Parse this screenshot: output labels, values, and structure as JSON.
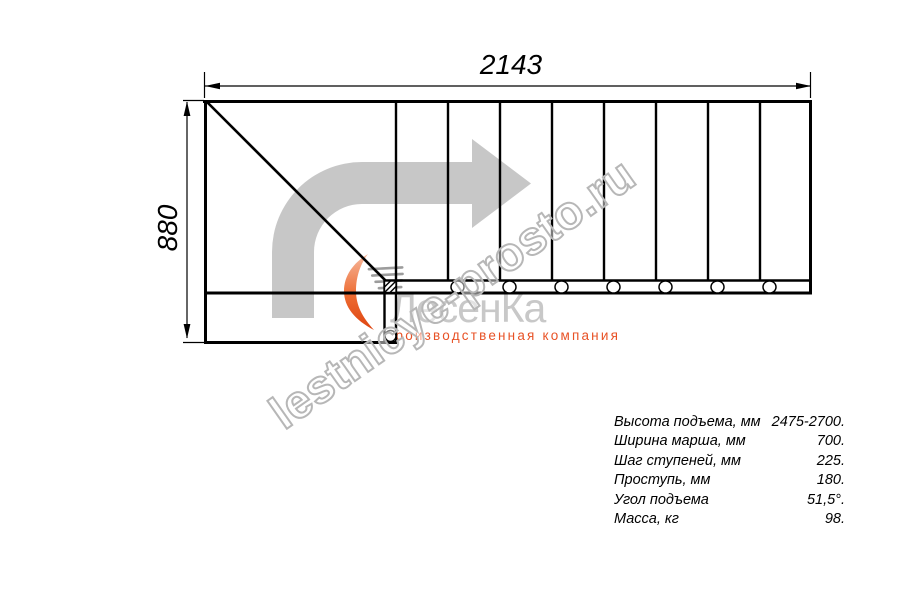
{
  "drawing": {
    "type": "staircase top-view plan",
    "width_label": "2143",
    "height_label": "880",
    "tread_count": 8,
    "colors": {
      "line": "#000000",
      "direction_arrow": "#c7c7c7",
      "watermark_outline": "#b7b7b7",
      "logo_gray": "#c8c8c8",
      "logo_orange": "#e85226"
    }
  },
  "watermark": {
    "text": "lestnicye-prosto.ru"
  },
  "logo": {
    "name": "ЛесенКа",
    "subtitle": "производственная компания"
  },
  "specs": {
    "rows": [
      {
        "label": "Высота подъема, мм",
        "value": "2475-2700."
      },
      {
        "label": "Ширина марша, мм",
        "value": "700."
      },
      {
        "label": "Шаг ступеней, мм",
        "value": "225."
      },
      {
        "label": "Проступь, мм",
        "value": "180."
      },
      {
        "label": "Угол подъема",
        "value": "51,5°."
      },
      {
        "label": "Масса, кг",
        "value": "98."
      }
    ]
  }
}
